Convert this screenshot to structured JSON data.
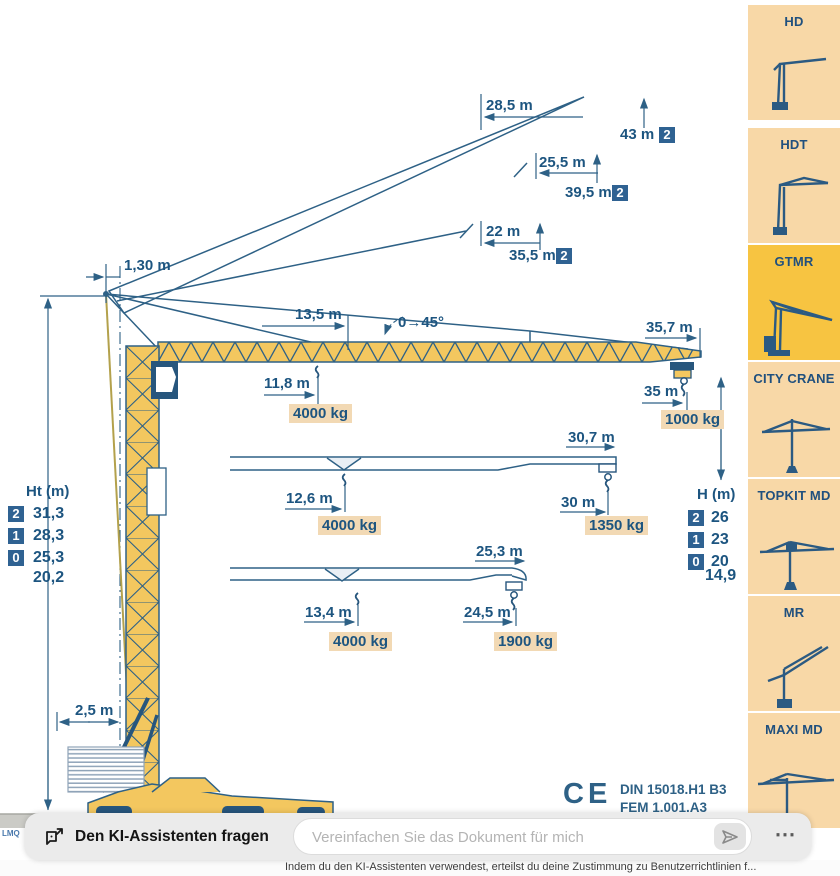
{
  "diagram": {
    "labels": {
      "top_offset": "1,30 m",
      "pos1_radius": "28,5 m",
      "pos1_height": "43 m",
      "pos1_badge": "2",
      "pos2_radius": "25,5 m",
      "pos2_height": "39,5 m",
      "pos2_badge": "2",
      "pos3_radius": "22 m",
      "pos3_height": "35,5 m",
      "pos3_badge": "2",
      "jib_root_length": "13,5 m",
      "luffing_angle": "0→45°",
      "jib_full_length": "35,7 m",
      "hook1_radius": "11,8 m",
      "hook1_load": "4000 kg",
      "tip1_radius": "35 m",
      "tip1_load": "1000 kg",
      "jib2_length": "30,7 m",
      "hook2_radius": "12,6 m",
      "hook2_load": "4000 kg",
      "tip2_radius": "30 m",
      "tip2_load": "1350 kg",
      "jib3_length": "25,3 m",
      "hook3_radius": "13,4 m",
      "hook3_load": "4000 kg",
      "tip3_radius": "24,5 m",
      "tip3_load": "1900 kg",
      "base_width": "2,5 m",
      "ce_mark": "CE",
      "standard1": "DIN 15018.H1 B3",
      "standard2": "FEM 1.001.A3",
      "side_note": "LMQ"
    },
    "ht_table": {
      "header": "Ht (m)",
      "rows": [
        {
          "badge": "2",
          "value": "31,3"
        },
        {
          "badge": "1",
          "value": "28,3"
        },
        {
          "badge": "0",
          "value": "25,3"
        },
        {
          "badge": "",
          "value": "20,2"
        }
      ]
    },
    "h_table": {
      "header": "H (m)",
      "rows": [
        {
          "badge": "2",
          "value": "26"
        },
        {
          "badge": "1",
          "value": "23"
        },
        {
          "badge": "0",
          "value": "20"
        },
        {
          "badge": "",
          "value": "14,9"
        }
      ]
    }
  },
  "sidebar": {
    "items": [
      {
        "label": "HD",
        "active": false
      },
      {
        "label": "HDT",
        "active": false
      },
      {
        "label": "GTMR",
        "active": true
      },
      {
        "label": "CITY CRANE",
        "active": false
      },
      {
        "label": "TOPKIT MD",
        "active": false
      },
      {
        "label": "MR",
        "active": false
      },
      {
        "label": "MAXI MD",
        "active": false
      }
    ]
  },
  "assistant_bar": {
    "title": "Den KI-Assistenten fragen",
    "input_placeholder": "Vereinfachen Sie das Dokument für mich",
    "menu_dots": "⋯",
    "disclaimer": "Indem du den KI-Assistenten verwendest, erteilst du deine Zustimmung zu Benutzerrichtlinien f..."
  },
  "colors": {
    "crane_yellow": "#f3c75f",
    "outline_blue": "#2e6186",
    "text_blue": "#1d5580",
    "badge_blue": "#2f6292",
    "load_label_bg": "#f2d9b4",
    "sidebar_card_bg": "#f8d8a7",
    "sidebar_active_bg": "#f7c441"
  }
}
